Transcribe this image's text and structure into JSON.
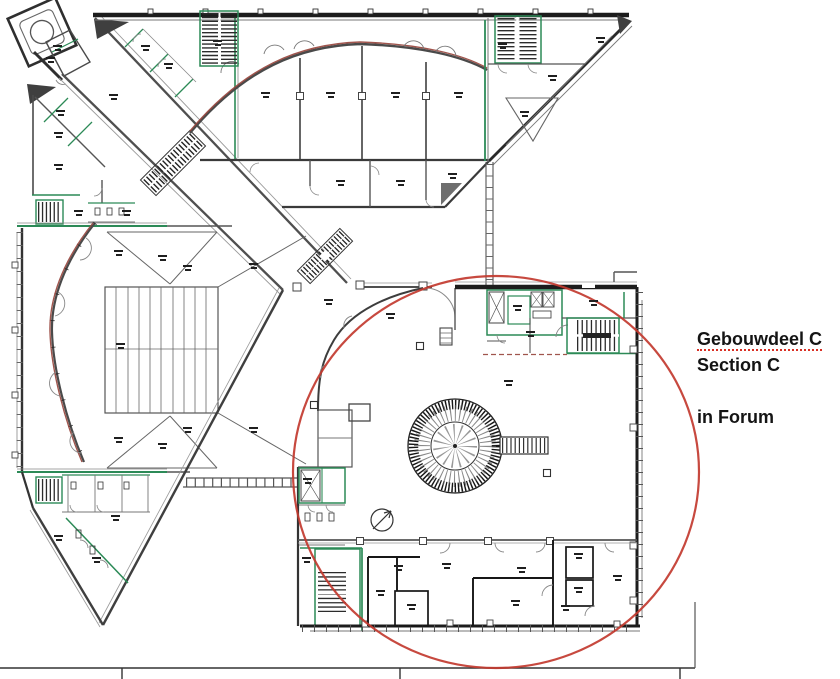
{
  "annotation": {
    "line1": "Gebouwdeel C",
    "line2": "Section C",
    "line3": "in Forum"
  },
  "colors": {
    "wall_gray": "#4f4f4f",
    "wall_black": "#1c1c1c",
    "wall_green": "#2c8a57",
    "legacy_arc": "#96423a",
    "highlight_circle": "#c2392f",
    "spellcheck_underline": "#d93025",
    "background": "#ffffff"
  },
  "plan": {
    "highlight": {
      "cx": 496,
      "cy": 472,
      "rx": 203,
      "ry": 196
    },
    "room_label_marks": [
      [
        57,
        48
      ],
      [
        50,
        60
      ],
      [
        145,
        48
      ],
      [
        168,
        66
      ],
      [
        113,
        97
      ],
      [
        217,
        43
      ],
      [
        60,
        113
      ],
      [
        58,
        135
      ],
      [
        58,
        167
      ],
      [
        78,
        213
      ],
      [
        126,
        213
      ],
      [
        265,
        95
      ],
      [
        330,
        95
      ],
      [
        395,
        95
      ],
      [
        458,
        95
      ],
      [
        340,
        183
      ],
      [
        400,
        183
      ],
      [
        452,
        176
      ],
      [
        524,
        114
      ],
      [
        552,
        78
      ],
      [
        600,
        40
      ],
      [
        502,
        46
      ],
      [
        118,
        253
      ],
      [
        187,
        268
      ],
      [
        120,
        346
      ],
      [
        118,
        440
      ],
      [
        187,
        430
      ],
      [
        253,
        266
      ],
      [
        253,
        430
      ],
      [
        162,
        258
      ],
      [
        162,
        446
      ],
      [
        58,
        538
      ],
      [
        96,
        560
      ],
      [
        115,
        518
      ],
      [
        390,
        316
      ],
      [
        328,
        302
      ],
      [
        508,
        383
      ],
      [
        517,
        308
      ],
      [
        530,
        334
      ],
      [
        593,
        303
      ],
      [
        380,
        593
      ],
      [
        411,
        607
      ],
      [
        398,
        568
      ],
      [
        446,
        566
      ],
      [
        521,
        570
      ],
      [
        515,
        603
      ],
      [
        578,
        556
      ],
      [
        578,
        590
      ],
      [
        617,
        578
      ],
      [
        565,
        608
      ],
      [
        307,
        481
      ],
      [
        306,
        560
      ]
    ]
  }
}
